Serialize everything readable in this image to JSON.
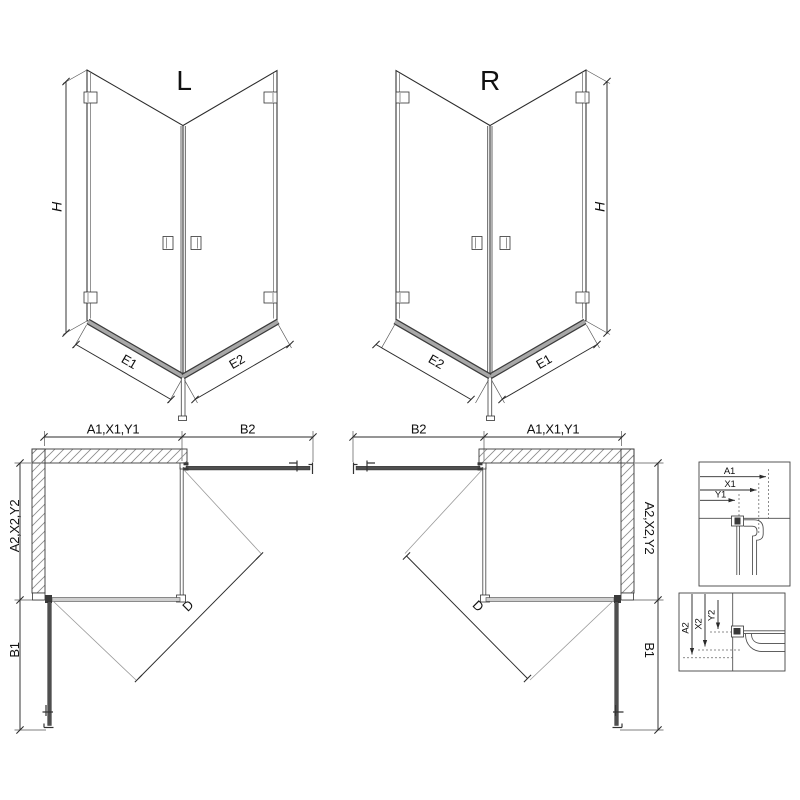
{
  "iso_left": {
    "label": "L",
    "height_dim": "H",
    "bottom_left_dim": "E1",
    "bottom_right_dim": "E2"
  },
  "iso_right": {
    "label": "R",
    "height_dim": "H",
    "bottom_left_dim": "E2",
    "bottom_right_dim": "E1"
  },
  "plan_left": {
    "width_dim": "A1,X1,Y1",
    "door_top_dim": "B2",
    "depth_dim": "A2,X2,Y2",
    "door_side_dim": "B1",
    "diagonal_dim": "D"
  },
  "plan_right": {
    "width_dim": "A1,X1,Y1",
    "door_top_dim": "B2",
    "depth_dim": "A2,X2,Y2",
    "door_side_dim": "B1",
    "diagonal_dim": "D"
  },
  "detail_top": {
    "dim_a": "A1",
    "dim_x": "X1",
    "dim_y": "Y1"
  },
  "detail_bottom": {
    "dim_a": "A2",
    "dim_x": "X2",
    "dim_y": "Y2"
  },
  "colors": {
    "line": "#2b2b2b",
    "light_line": "#8f8f8f",
    "door_fill": "#4f4f4f",
    "glass_fill": "#cfcfcf",
    "threshold_fill": "#a8a8a8",
    "hatch_line": "#8a8a8a",
    "text": "#111111"
  }
}
